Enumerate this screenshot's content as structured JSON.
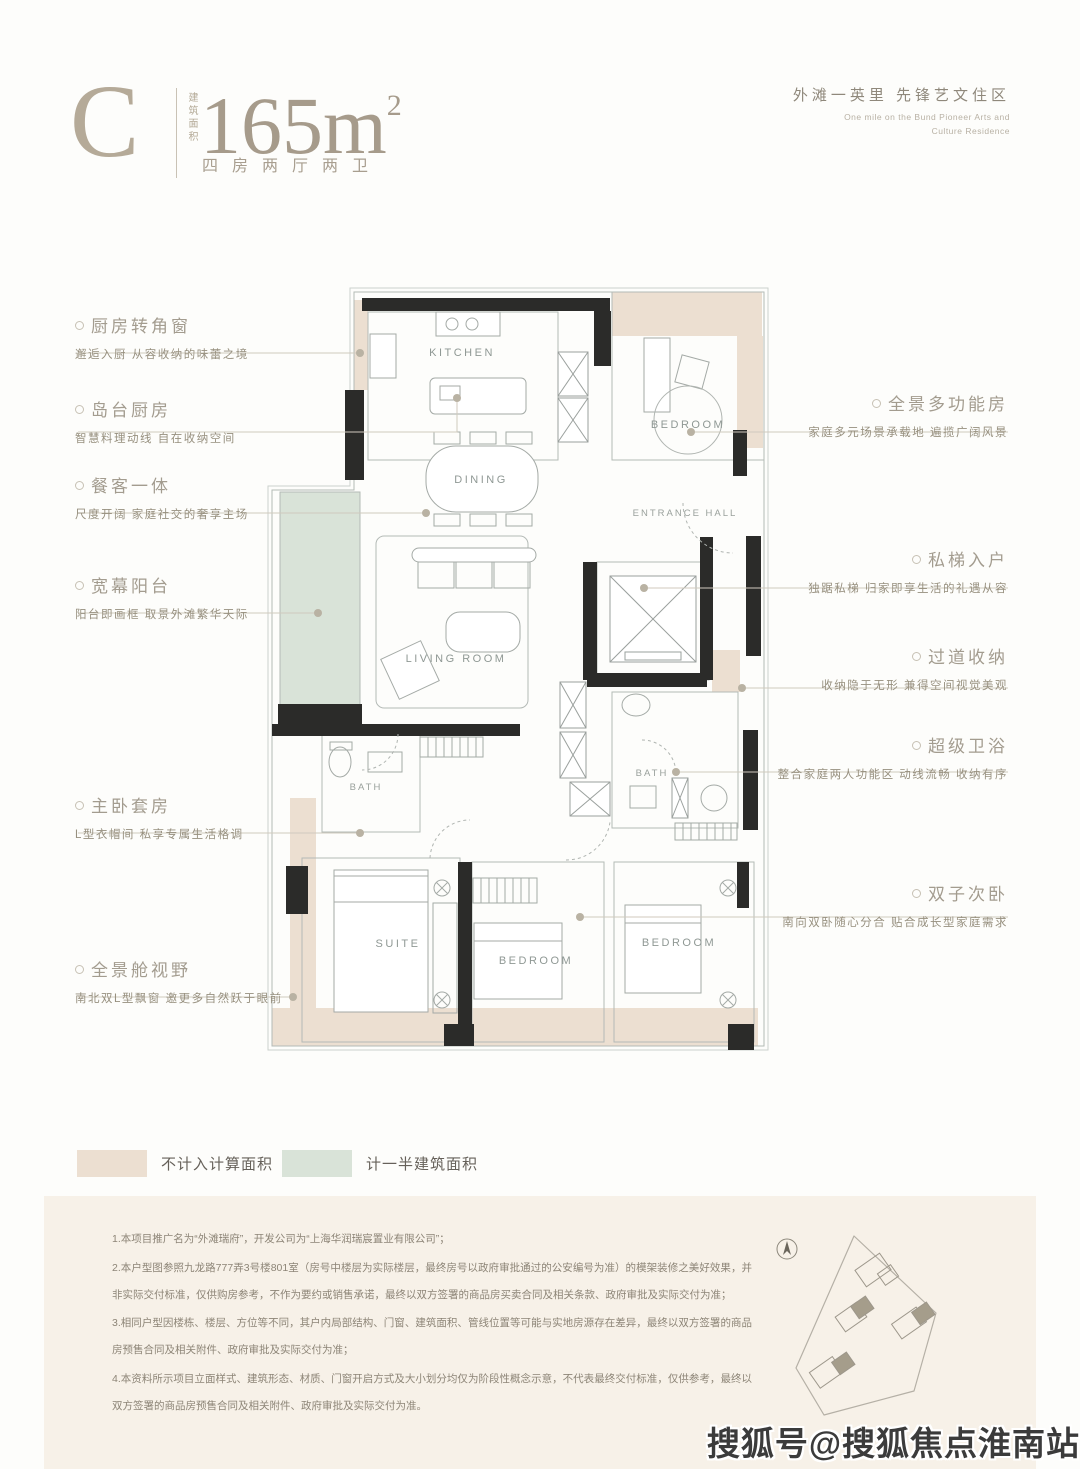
{
  "header": {
    "unit_letter": "C",
    "area_prefix_vertical": "建筑面积",
    "area_value": "165m",
    "area_exponent": "2",
    "layout_spec": "四房两厅两卫",
    "slogan_cn": "外滩一英里 先锋艺文住区",
    "slogan_en_line1": "One mile on the Bund Pioneer Arts and",
    "slogan_en_line2": "Culture Residence"
  },
  "plan": {
    "labels": {
      "kitchen": "KITCHEN",
      "dining": "DINING",
      "living_room": "LIVING ROOM",
      "bedroom_top": "BEDROOM",
      "entrance_hall": "ENTRANCE HALL",
      "bath_left": "BATH",
      "bath_right": "BATH",
      "suite": "SUITE",
      "bedroom_middle": "BEDROOM",
      "bedroom_right": "BEDROOM"
    }
  },
  "callouts_left": [
    {
      "title": "厨房转角窗",
      "desc": "邂逅入厨 从容收纳的味蕾之境"
    },
    {
      "title": "岛台厨房",
      "desc": "智慧料理动线 自在收纳空间"
    },
    {
      "title": "餐客一体",
      "desc": "尺度开阔 家庭社交的奢享主场"
    },
    {
      "title": "宽幕阳台",
      "desc": "阳台即画框 取景外滩繁华天际"
    },
    {
      "title": "主卧套房",
      "desc": "L型衣帽间 私享专属生活格调"
    },
    {
      "title": "全景舱视野",
      "desc": "南北双L型飘窗 邀更多自然跃于眼前"
    }
  ],
  "callouts_right": [
    {
      "title": "全景多功能房",
      "desc": "家庭多元场景承载地 遍揽广阔风景"
    },
    {
      "title": "私梯入户",
      "desc": "独踞私梯 归家即享生活的礼遇从容"
    },
    {
      "title": "过道收纳",
      "desc": "收纳隐于无形 兼得空间视觉美观"
    },
    {
      "title": "超级卫浴",
      "desc": "整合家庭两人功能区 动线流畅 收纳有序"
    },
    {
      "title": "双子次卧",
      "desc": "南向双卧随心分合 贴合成长型家庭需求"
    }
  ],
  "legend": {
    "items": [
      {
        "label": "不计入计算面积",
        "color": "#ecdfd1"
      },
      {
        "label": "计一半建筑面积",
        "color": "#d9e3d8"
      }
    ]
  },
  "plan_colors": {
    "wall": "#2b2b29",
    "outline": "#b4bab6"
  },
  "disclaimer": {
    "paragraphs": [
      "1.本项目推广名为“外滩瑞府”，开发公司为“上海华润瑞宸置业有限公司”；",
      "2.本户型图参照九龙路777弄3号楼801室（房号中楼层为实际楼层，最终房号以政府审批通过的公安编号为准）的模架装修之美好效果，并非实际交付标准，仅供购房参考，不作为要约或销售承诺，最终以双方签署的商品房买卖合同及相关条款、政府审批及实际交付为准；",
      "3.相同户型因楼栋、楼层、方位等不同，其户内局部结构、门窗、建筑面积、管线位置等可能与实地房源存在差异，最终以双方签署的商品房预售合同及相关附件、政府审批及实际交付为准；",
      "4.本资料所示项目立面样式、建筑形态、材质、门窗开启方式及大小划分均仅为阶段性概念示意，不代表最终交付标准，仅供参考，最终以双方签署的商品房预售合同及相关附件、政府审批及实际交付为准。"
    ]
  },
  "watermark": "搜狐号@搜狐焦点淮南站"
}
